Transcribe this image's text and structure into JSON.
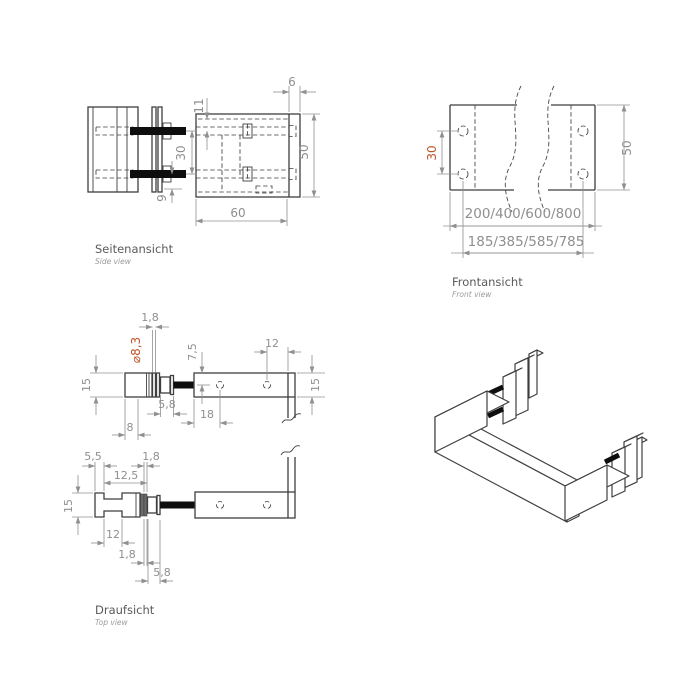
{
  "page": {
    "background": "#ffffff"
  },
  "colors": {
    "line": "#3f3f3f",
    "dimension": "#909090",
    "accent": "#bf5226",
    "screw": "#0e0e0e"
  },
  "side": {
    "title": "Seitenansicht",
    "subtitle": "Side view",
    "d6": "6",
    "d11": "11",
    "d30": "30",
    "d50": "50",
    "d60": "60",
    "d9": "9"
  },
  "front": {
    "title": "Frontansicht",
    "subtitle": "Front view",
    "d30": "30",
    "d50": "50",
    "lengths": "200/400/600/800",
    "spacings": "185/385/585/785"
  },
  "topv": {
    "title": "Draufsicht",
    "subtitle": "Top view",
    "u18": "1,8",
    "dia": "⌀8,3",
    "u75": "7,5",
    "u12": "12",
    "u15l": "15",
    "u15r": "15",
    "u58": "5,8",
    "u18b": "18",
    "u8": "8",
    "l55": "5,5",
    "l18a": "1,8",
    "l125": "12,5",
    "l15": "15",
    "l12": "12",
    "l18b": "1,8",
    "l58": "5,8"
  }
}
